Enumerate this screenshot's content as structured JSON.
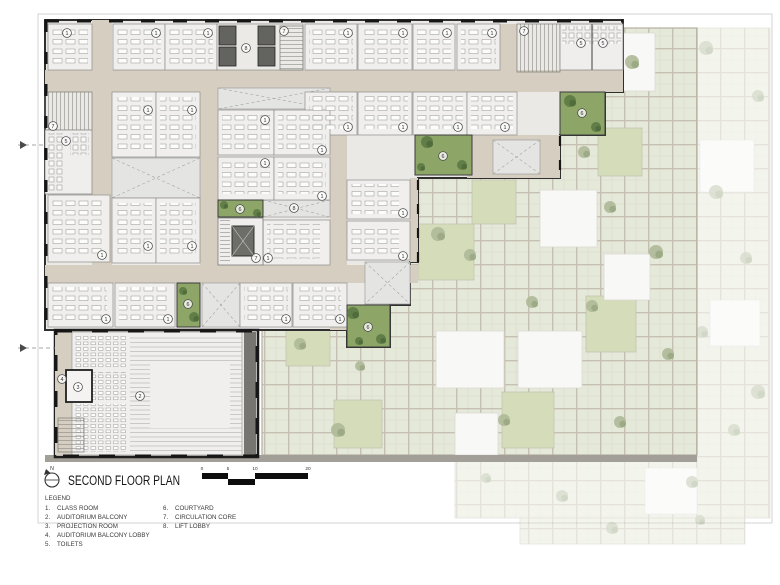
{
  "drawing": {
    "title": "SECOND FLOOR PLAN",
    "north_label": "N",
    "scale_bar": {
      "labels": [
        "0",
        "5",
        "10",
        "20"
      ]
    },
    "legend": {
      "heading": "LEGEND",
      "items": [
        {
          "n": "1.",
          "label": "CLASS ROOM"
        },
        {
          "n": "2.",
          "label": "AUDITORIUM BALCONY"
        },
        {
          "n": "3.",
          "label": "PROJECTION ROOM"
        },
        {
          "n": "4.",
          "label": "AUDITORIUM BALCONY LOBBY"
        },
        {
          "n": "5.",
          "label": "TOILETS"
        },
        {
          "n": "6.",
          "label": "COURTYARD"
        },
        {
          "n": "7.",
          "label": "CIRCULATION CORE"
        },
        {
          "n": "8.",
          "label": "LIFT LOBBY"
        }
      ]
    },
    "colors": {
      "corridor": "#d6cec0",
      "room": "#f0efed",
      "building_base": "#ebe9e6",
      "wall": "#2f2f2f",
      "courtyard": "#8da668",
      "courtyard_tree": "#5d7a45",
      "lightwell": "#e4e4e2",
      "lift": "#63635f",
      "plaza_tile": "#e5e9d9",
      "plaza_grout": "#c6c0b2",
      "plaza_white": "#f8f8f6",
      "plaza_green": "#d4dcba",
      "edge_band": "#a29f99"
    },
    "room_labels": [
      {
        "n": "1",
        "x": 67,
        "y": 33
      },
      {
        "n": "1",
        "x": 156,
        "y": 33
      },
      {
        "n": "1",
        "x": 208,
        "y": 33
      },
      {
        "n": "1",
        "x": 348,
        "y": 33
      },
      {
        "n": "1",
        "x": 403,
        "y": 33
      },
      {
        "n": "1",
        "x": 447,
        "y": 33
      },
      {
        "n": "1",
        "x": 492,
        "y": 33
      },
      {
        "n": "1",
        "x": 348,
        "y": 127
      },
      {
        "n": "1",
        "x": 403,
        "y": 127
      },
      {
        "n": "1",
        "x": 458,
        "y": 127
      },
      {
        "n": "1",
        "x": 505,
        "y": 127
      },
      {
        "n": "1",
        "x": 148,
        "y": 110
      },
      {
        "n": "1",
        "x": 192,
        "y": 110
      },
      {
        "n": "1",
        "x": 148,
        "y": 246
      },
      {
        "n": "1",
        "x": 192,
        "y": 246
      },
      {
        "n": "1",
        "x": 265,
        "y": 120
      },
      {
        "n": "1",
        "x": 322,
        "y": 150
      },
      {
        "n": "1",
        "x": 265,
        "y": 163
      },
      {
        "n": "1",
        "x": 322,
        "y": 196
      },
      {
        "n": "1",
        "x": 268,
        "y": 258
      },
      {
        "n": "1",
        "x": 403,
        "y": 213
      },
      {
        "n": "1",
        "x": 403,
        "y": 256
      },
      {
        "n": "1",
        "x": 102,
        "y": 255
      },
      {
        "n": "1",
        "x": 106,
        "y": 319
      },
      {
        "n": "1",
        "x": 168,
        "y": 319
      },
      {
        "n": "1",
        "x": 286,
        "y": 319
      },
      {
        "n": "1",
        "x": 340,
        "y": 319
      },
      {
        "n": "2",
        "x": 140,
        "y": 396
      },
      {
        "n": "3",
        "x": 78,
        "y": 387
      },
      {
        "n": "4",
        "x": 62,
        "y": 379
      },
      {
        "n": "5",
        "x": 66,
        "y": 141
      },
      {
        "n": "5",
        "x": 581,
        "y": 43
      },
      {
        "n": "5",
        "x": 603,
        "y": 43
      },
      {
        "n": "6",
        "x": 582,
        "y": 113
      },
      {
        "n": "6",
        "x": 443,
        "y": 156
      },
      {
        "n": "6",
        "x": 240,
        "y": 209
      },
      {
        "n": "6",
        "x": 188,
        "y": 304
      },
      {
        "n": "6",
        "x": 368,
        "y": 327
      },
      {
        "n": "7",
        "x": 53,
        "y": 126
      },
      {
        "n": "7",
        "x": 284,
        "y": 31
      },
      {
        "n": "7",
        "x": 524,
        "y": 31
      },
      {
        "n": "7",
        "x": 256,
        "y": 258
      },
      {
        "n": "8",
        "x": 246,
        "y": 48
      },
      {
        "n": "8",
        "x": 294,
        "y": 208
      }
    ],
    "courtyard_trees": [
      [
        570,
        101,
        6
      ],
      [
        596,
        127,
        5
      ],
      [
        427,
        142,
        6
      ],
      [
        462,
        165,
        5
      ],
      [
        421,
        167,
        4
      ],
      [
        224,
        205,
        4
      ],
      [
        257,
        213,
        4
      ],
      [
        183,
        291,
        4
      ],
      [
        194,
        317,
        5
      ],
      [
        353,
        313,
        6
      ],
      [
        381,
        339,
        5
      ],
      [
        359,
        341,
        4
      ]
    ],
    "plaza": {
      "white_squares": [
        [
          598,
          33,
          57,
          58
        ],
        [
          540,
          190,
          57,
          57
        ],
        [
          604,
          254,
          46,
          46
        ],
        [
          436,
          331,
          68,
          57
        ],
        [
          518,
          331,
          64,
          57
        ],
        [
          455,
          413,
          43,
          42
        ]
      ],
      "green_squares": [
        [
          478,
          128,
          48,
          48
        ],
        [
          598,
          128,
          44,
          48
        ],
        [
          418,
          224,
          56,
          56
        ],
        [
          586,
          296,
          50,
          56
        ],
        [
          502,
          392,
          52,
          56
        ],
        [
          286,
          322,
          44,
          44
        ],
        [
          334,
          400,
          48,
          48
        ],
        [
          472,
          180,
          44,
          44
        ]
      ],
      "trees": [
        [
          632,
          62,
          7
        ],
        [
          610,
          207,
          6
        ],
        [
          656,
          252,
          7
        ],
        [
          592,
          306,
          6
        ],
        [
          668,
          354,
          6
        ],
        [
          438,
          234,
          7
        ],
        [
          470,
          255,
          6
        ],
        [
          532,
          302,
          6
        ],
        [
          300,
          344,
          6
        ],
        [
          338,
          430,
          7
        ],
        [
          620,
          422,
          6
        ],
        [
          584,
          152,
          6
        ],
        [
          504,
          420,
          6
        ],
        [
          360,
          366,
          5
        ]
      ],
      "faded_white_squares": [
        [
          700,
          140,
          54,
          52
        ],
        [
          710,
          300,
          50,
          46
        ],
        [
          645,
          468,
          52,
          46
        ]
      ],
      "faded_trees": [
        [
          706,
          48,
          7
        ],
        [
          758,
          96,
          6
        ],
        [
          716,
          192,
          7
        ],
        [
          746,
          258,
          6
        ],
        [
          702,
          332,
          6
        ],
        [
          758,
          392,
          7
        ],
        [
          692,
          482,
          6
        ],
        [
          562,
          496,
          6
        ],
        [
          612,
          528,
          6
        ],
        [
          486,
          478,
          5
        ],
        [
          734,
          430,
          6
        ],
        [
          700,
          520,
          5
        ]
      ]
    }
  }
}
